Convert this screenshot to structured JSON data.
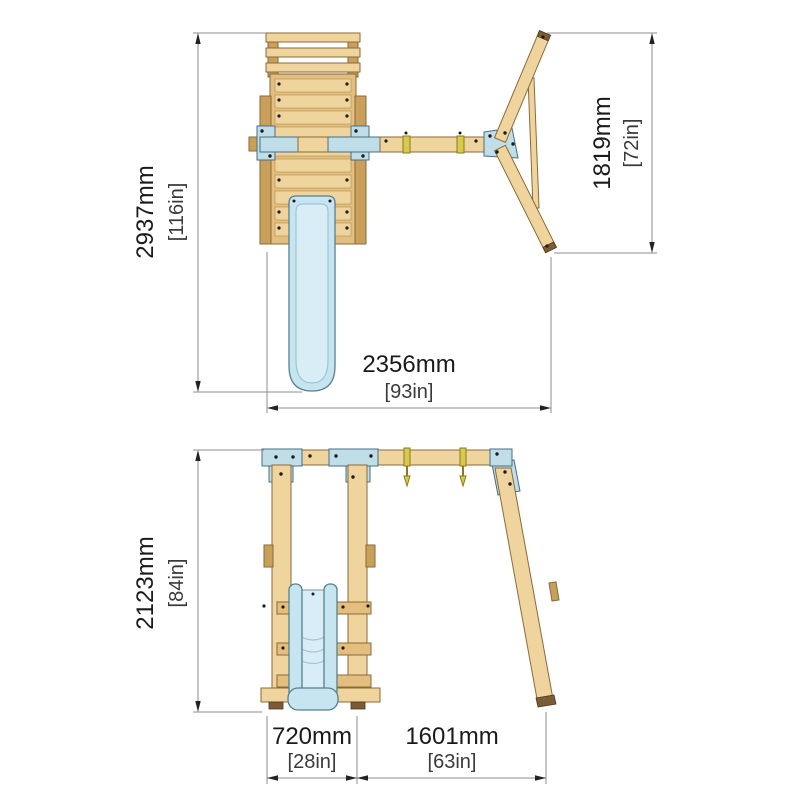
{
  "palette": {
    "background": "#FFFFFF",
    "wood_light": "#F0D49E",
    "wood_mid": "#E3BE7E",
    "wood_dark": "#C9A05B",
    "wood_outline": "#8A6A3A",
    "metal_blue": "#BFDEE8",
    "metal_outline": "#4A6E80",
    "slide_blue": "#C7E5F1",
    "slide_light": "#D8EDF6",
    "slide_outline": "#56808F",
    "brass": "#D9C84E",
    "brass_dark": "#8A7A1E",
    "foot_brown": "#7A5C36",
    "dim": "#8C8C8C",
    "text": "#1A1A1A"
  },
  "top_view": {
    "label": "top view",
    "dimensions": {
      "overall_depth": {
        "mm": "2937mm",
        "inches": "[116in]"
      },
      "aframe_spread": {
        "mm": "1819mm",
        "inches": "[72in]"
      },
      "overall_width": {
        "mm": "2356mm",
        "inches": "[93in]"
      }
    }
  },
  "front_view": {
    "label": "front view",
    "dimensions": {
      "overall_height": {
        "mm": "2123mm",
        "inches": "[84in]"
      },
      "tower_width": {
        "mm": "720mm",
        "inches": "[28in]"
      },
      "swing_bay_width": {
        "mm": "1601mm",
        "inches": "[63in]"
      }
    }
  }
}
